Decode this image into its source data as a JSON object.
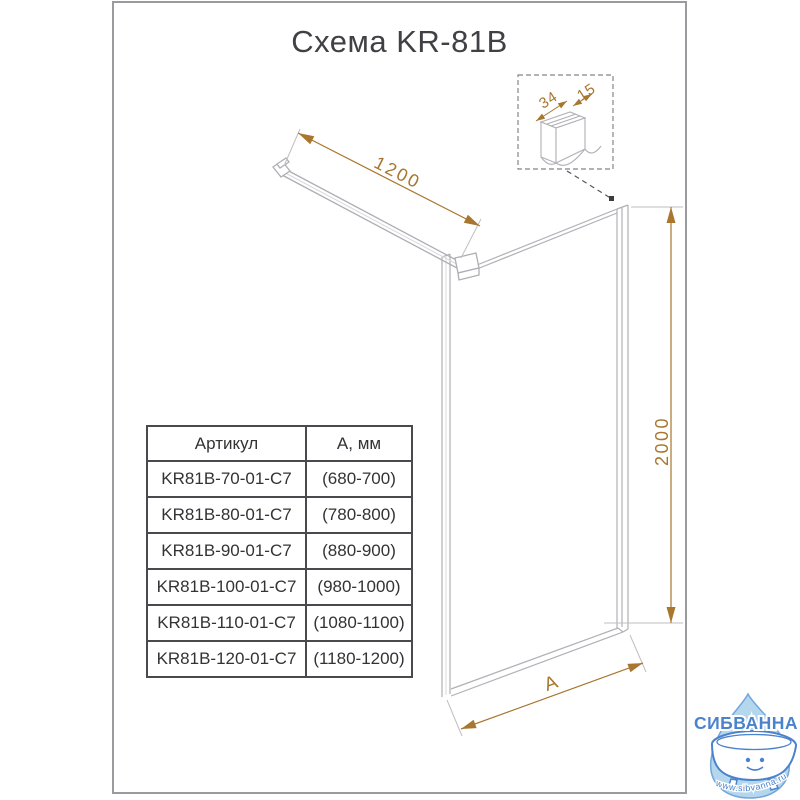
{
  "title": "Схема KR-81B",
  "drawing": {
    "bar_length_label": "1200",
    "height_label": "2000",
    "width_label": "A",
    "detail": {
      "depth_label": "34",
      "thickness_label": "15"
    }
  },
  "table": {
    "headers": [
      "Артикул",
      "А, мм"
    ],
    "rows": [
      [
        "KR81B-70-01-C7",
        "(680-700)"
      ],
      [
        "KR81B-80-01-C7",
        "(780-800)"
      ],
      [
        "KR81B-90-01-C7",
        "(880-900)"
      ],
      [
        "KR81B-100-01-C7",
        "(980-1000)"
      ],
      [
        "KR81B-110-01-C7",
        "(1080-1100)"
      ],
      [
        "KR81B-120-01-C7",
        "(1180-1200)"
      ]
    ]
  },
  "watermark": {
    "brand": "СИБВАННА",
    "site": "www.sibvanna.ru"
  },
  "colors": {
    "dimension": "#a8762e",
    "drawing_line": "#b0b0b6",
    "logo_blue": "#4b82cc",
    "logo_drop_fill": "#b5d7ee",
    "text": "#404045"
  }
}
